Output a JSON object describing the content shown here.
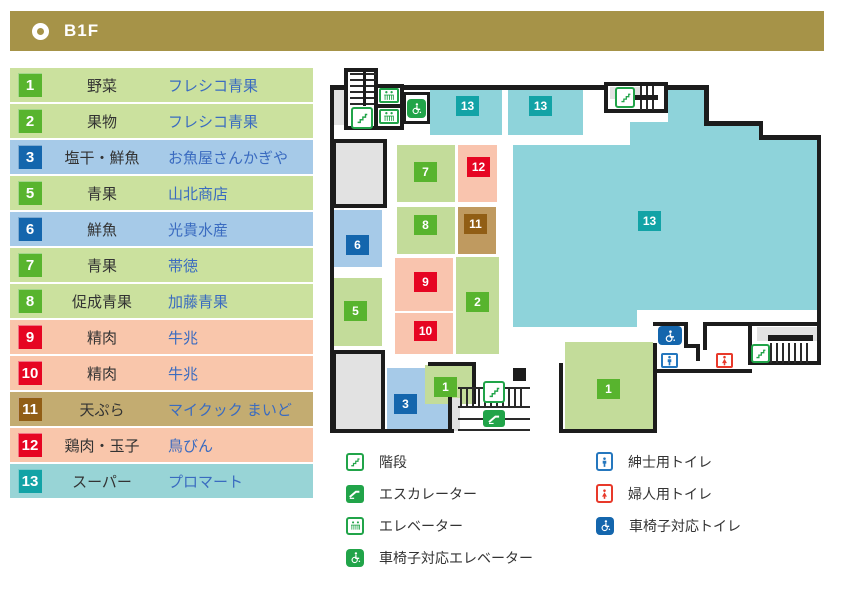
{
  "header": {
    "title": "B1F"
  },
  "directory": {
    "rows": [
      {
        "num": "1",
        "category": "野菜",
        "store": "フレシコ青果",
        "color": "green"
      },
      {
        "num": "2",
        "category": "果物",
        "store": "フレシコ青果",
        "color": "green"
      },
      {
        "num": "3",
        "category": "塩干・鮮魚",
        "store": "お魚屋さんかぎや",
        "color": "blue"
      },
      {
        "num": "5",
        "category": "青果",
        "store": "山北商店",
        "color": "green"
      },
      {
        "num": "6",
        "category": "鮮魚",
        "store": "光貴水産",
        "color": "blue"
      },
      {
        "num": "7",
        "category": "青果",
        "store": "帯徳",
        "color": "green"
      },
      {
        "num": "8",
        "category": "促成青果",
        "store": "加藤青果",
        "color": "green"
      },
      {
        "num": "9",
        "category": "精肉",
        "store": "牛兆",
        "color": "red"
      },
      {
        "num": "10",
        "category": "精肉",
        "store": "牛兆",
        "color": "red"
      },
      {
        "num": "11",
        "category": "天ぷら",
        "store": "マイクック まいど",
        "color": "khaki"
      },
      {
        "num": "12",
        "category": "鶏肉・玉子",
        "store": "鳥びん",
        "color": "red"
      },
      {
        "num": "13",
        "category": "スーパー",
        "store": "プロマート",
        "color": "teal"
      }
    ]
  },
  "map": {
    "badges": [
      {
        "zone": "supermarket-top-left",
        "label": "13"
      },
      {
        "zone": "supermarket-top-right",
        "label": "13"
      },
      {
        "zone": "supermarket-main",
        "label": "13"
      },
      {
        "zone": "produce-7",
        "label": "7"
      },
      {
        "zone": "chicken-eggs-12",
        "label": "12"
      },
      {
        "zone": "forced-produce-8",
        "label": "8"
      },
      {
        "zone": "tempura-11",
        "label": "11"
      },
      {
        "zone": "fresh-fish-6",
        "label": "6"
      },
      {
        "zone": "produce-5",
        "label": "5"
      },
      {
        "zone": "meat-9",
        "label": "9"
      },
      {
        "zone": "meat-10",
        "label": "10"
      },
      {
        "zone": "fruit-2",
        "label": "2"
      },
      {
        "zone": "salted-fish-3",
        "label": "3"
      },
      {
        "zone": "vegetables-1-small",
        "label": "1"
      },
      {
        "zone": "vegetables-1-large",
        "label": "1"
      }
    ]
  },
  "legend": {
    "left": [
      {
        "icon": "stairs",
        "label": "階段"
      },
      {
        "icon": "escalator",
        "label": "エスカレーター"
      },
      {
        "icon": "elevator",
        "label": "エレベーター"
      },
      {
        "icon": "wheelchair-elevator",
        "label": "車椅子対応エレベーター"
      }
    ],
    "right": [
      {
        "icon": "mens-toilet",
        "label": "紳士用トイレ"
      },
      {
        "icon": "womens-toilet",
        "label": "婦人用トイレ"
      },
      {
        "icon": "wheelchair-toilet",
        "label": "車椅子対応トイレ"
      }
    ]
  },
  "colors": {
    "header_gold": "#a69348",
    "row_green": "#cbe19e",
    "row_blue": "#a6cae8",
    "row_pink": "#f9c6ab",
    "row_khaki": "#c3ac71",
    "row_teal": "#98d4d6",
    "badge_green": "#58b42e",
    "badge_blue": "#1466ad",
    "badge_red": "#e60522",
    "badge_brown": "#915e15",
    "badge_teal": "#12a3a6",
    "map_teal": "#8ed3da",
    "map_green": "#c3dc9a",
    "map_pink": "#f9c4ae",
    "map_brown": "#bf9a60",
    "map_blue": "#a6cae8",
    "store_text": "#3a6bc0",
    "category_text": "#333333",
    "icon_green": "#21a449",
    "toilet_blue": "#2577be",
    "toilet_red": "#e8392a",
    "wall": "#1c1c1c",
    "gray_block": "#e2e2e2"
  }
}
